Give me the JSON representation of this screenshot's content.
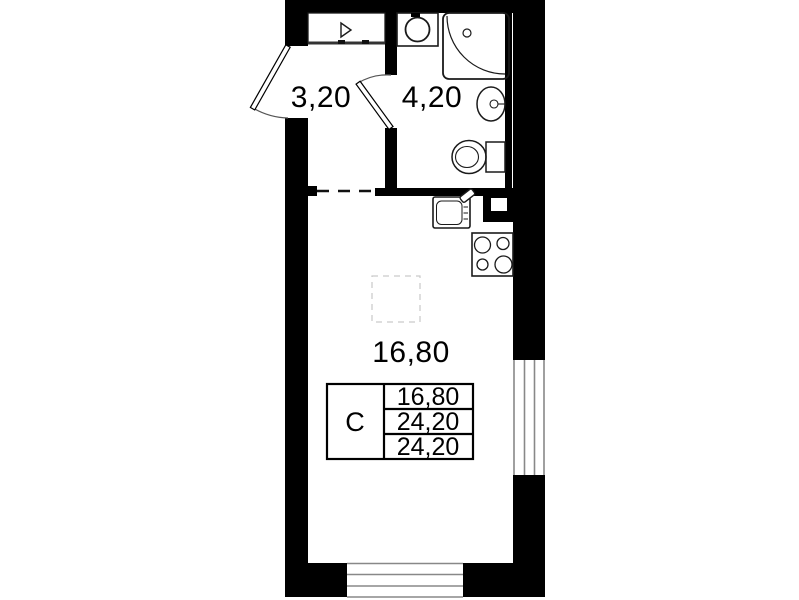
{
  "plan": {
    "title": "studio-apartment-floor-plan",
    "rooms": [
      {
        "id": "hall",
        "area_label": "3,20"
      },
      {
        "id": "bathroom",
        "area_label": "4,20"
      },
      {
        "id": "living",
        "area_label": "16,80"
      }
    ],
    "legend_table": {
      "type_label": "С",
      "rows": [
        {
          "value": "16,80"
        },
        {
          "value": "24,20"
        },
        {
          "value": "24,20"
        }
      ]
    },
    "colors": {
      "wall": "#000000",
      "fixture_line": "#1a1a1a",
      "window_line": "#888888",
      "door_arc": "#555555",
      "ghost_outline": "#c9c9c9",
      "background": "#ffffff"
    }
  }
}
